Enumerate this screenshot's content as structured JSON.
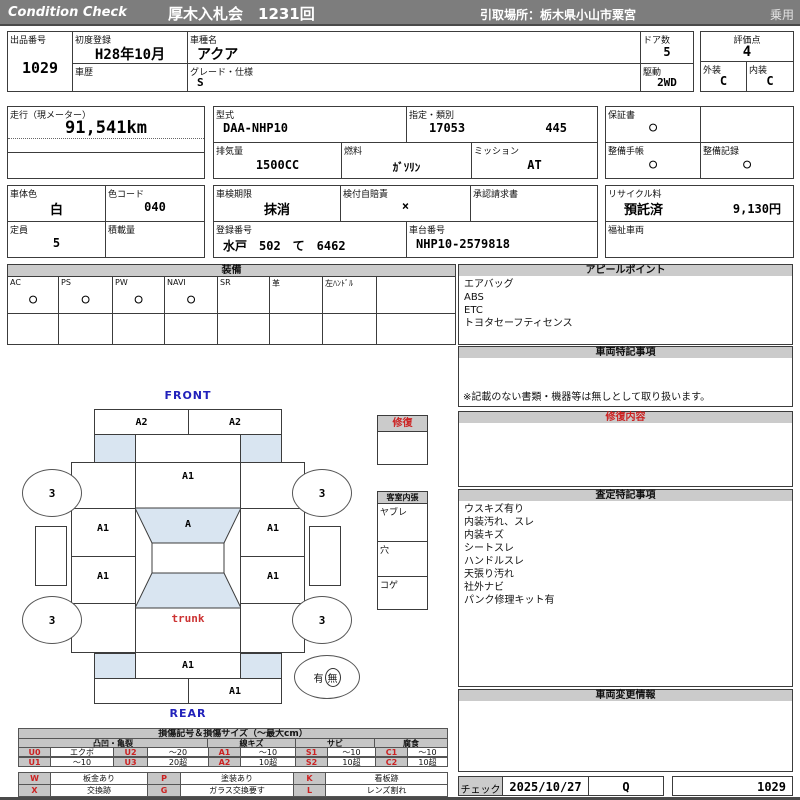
{
  "colors": {
    "header_bg": "#7d7d7d",
    "section_bar_bg": "#cbcbcb",
    "diagram_fill": "#d9e5f1",
    "code_red": "#cc2222",
    "label_blue": "#2222bb"
  },
  "header": {
    "brand": "Condition  Check",
    "auction_title": "厚木入札会　1231回",
    "pickup_location": "引取場所：栃木県小山市粟宮",
    "vehicle_class": "乗用"
  },
  "info": {
    "exhibit_no": {
      "label": "出品番号",
      "value": "1029"
    },
    "first_reg": {
      "label": "初度登録",
      "value": "H28年10月"
    },
    "history": {
      "label": "車歴",
      "value": ""
    },
    "model_name": {
      "label": "車種名",
      "value": "アクア"
    },
    "grade": {
      "label": "グレード・仕様",
      "value": "S"
    },
    "doors": {
      "label": "ドア数",
      "value": "5"
    },
    "drive": {
      "label": "駆動",
      "value": "2WD"
    },
    "score": {
      "label": "評価点",
      "value": "4"
    },
    "exterior": {
      "label": "外装",
      "value": "C"
    },
    "interior": {
      "label": "内装",
      "value": "C"
    },
    "mileage": {
      "label": "走行（現メーター）",
      "value": "91,541km"
    },
    "model_code": {
      "label": "型式",
      "value": "DAA-NHP10"
    },
    "class_code": {
      "label": "指定・類別",
      "value1": "17053",
      "value2": "445"
    },
    "displacement": {
      "label": "排気量",
      "value": "1500CC"
    },
    "fuel": {
      "label": "燃料",
      "value": "ｶﾞｿﾘﾝ"
    },
    "mission": {
      "label": "ミッション",
      "value": "AT"
    },
    "warranty": {
      "label": "保証書",
      "value": "○"
    },
    "maint_book": {
      "label": "整備手帳",
      "value": "○"
    },
    "maint_record": {
      "label": "整備記録",
      "value": "○"
    },
    "body_color": {
      "label": "車体色",
      "value": "白"
    },
    "color_code": {
      "label": "色コード",
      "value": "040"
    },
    "inspection": {
      "label": "車検期限",
      "value": "抹消"
    },
    "insurance": {
      "label": "検付自賠責",
      "value": "×"
    },
    "approval": {
      "label": "承認請求書",
      "value": ""
    },
    "recycle": {
      "label": "リサイクル料",
      "status": "預託済",
      "fee": "9,130円"
    },
    "capacity": {
      "label": "定員",
      "value": "5"
    },
    "load": {
      "label": "積載量",
      "value": ""
    },
    "reg_no": {
      "label": "登録番号",
      "value": "水戸　502　て　6462"
    },
    "chassis_no": {
      "label": "車台番号",
      "value": "NHP10-2579818"
    },
    "welfare": {
      "label": "福祉車両",
      "value": ""
    }
  },
  "equipment": {
    "title": "装備",
    "items": [
      {
        "label": "AC",
        "value": "○"
      },
      {
        "label": "PS",
        "value": "○"
      },
      {
        "label": "PW",
        "value": "○"
      },
      {
        "label": "NAVI",
        "value": "○"
      },
      {
        "label": "SR",
        "value": ""
      },
      {
        "label": "革",
        "value": ""
      },
      {
        "label": "左ﾊﾝﾄﾞﾙ",
        "value": ""
      },
      {
        "label": "",
        "value": ""
      }
    ]
  },
  "panels": {
    "appeal": {
      "title": "アピールポイント",
      "lines": [
        "エアバッグ",
        "ABS",
        "ETC",
        "トヨタセーフティセンス"
      ]
    },
    "vehicle_notes": {
      "title": "車両特記事項",
      "note": "※記載のない書類・機器等は無しとして取り扱います。"
    },
    "repair_detail": {
      "title": "修復内容"
    },
    "assessment": {
      "title": "査定特記事項",
      "lines": [
        "ウスキズ有り",
        "内装汚れ、スレ",
        "内装キズ",
        "シートスレ",
        "ハンドルスレ",
        "天張り汚れ",
        "社外ナビ",
        "パンク修理キット有"
      ]
    },
    "change_info": {
      "title": "車両変更情報"
    }
  },
  "diagram": {
    "front_label": "FRONT",
    "rear_label": "REAR",
    "trunk_label": "trunk",
    "front_bumper_left": "A2",
    "front_bumper_right": "A2",
    "hood": "A1",
    "windshield": "A",
    "door_front_left": "A1",
    "door_rear_left": "A1",
    "door_front_right": "A1",
    "door_rear_right": "A1",
    "rear_panel": "A1",
    "rear_bumper_right": "A1",
    "wheel_mark": "3",
    "spare_present": "有",
    "spare_absent": "無",
    "repair_box_title": "修復",
    "cabin_title": "客室内張",
    "cabin_rows": [
      "ヤブレ",
      "穴",
      "コゲ"
    ]
  },
  "legend": {
    "title": "損傷記号＆損傷サイズ（～最大cm）",
    "groups": [
      "凸凹・亀裂",
      "線キズ",
      "サビ",
      "腐食"
    ],
    "rows": [
      [
        "U0",
        "エクボ",
        "U2",
        "～20",
        "A1",
        "～10",
        "S1",
        "～10",
        "C1",
        "～10"
      ],
      [
        "U1",
        "～10",
        "U3",
        "20超",
        "A2",
        "10超",
        "S2",
        "10超",
        "C2",
        "10超"
      ]
    ],
    "rows2": [
      [
        "W",
        "板金あり",
        "P",
        "塗装あり",
        "K",
        "看板跡"
      ],
      [
        "X",
        "交換跡",
        "G",
        "ガラス交換要す",
        "L",
        "レンズ割れ"
      ]
    ]
  },
  "footer": {
    "check_label": "チェック",
    "date": "2025/10/27",
    "inspector": "Q",
    "sheet_no": "1029"
  }
}
